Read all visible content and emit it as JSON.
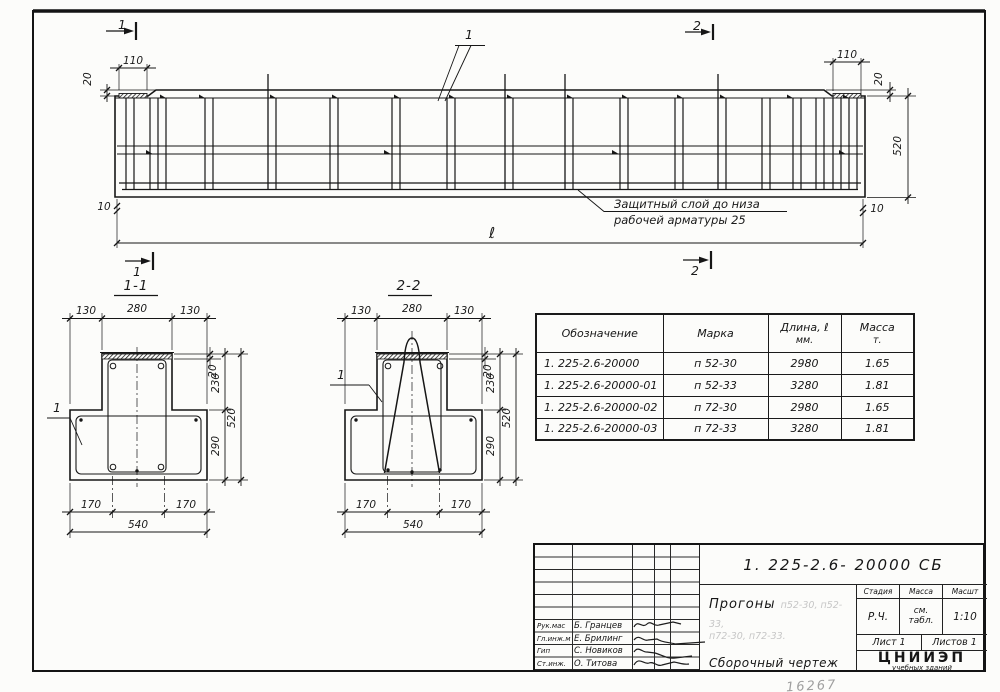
{
  "sheet": {
    "margin_note": "16267"
  },
  "elevation": {
    "mark_top_left": "1",
    "mark_top_right": "2",
    "mark_bottom_left": "1",
    "mark_bottom_right": "2",
    "callout": "1",
    "dim_pad_left": "110",
    "dim_pad_right": "110",
    "dim_step_left": "20",
    "dim_step_right": "20",
    "dim_height": "520",
    "dim_gap_left": "10",
    "dim_gap_right": "10",
    "dim_length": "ℓ",
    "note_line1": "Защитный слой до низа",
    "note_line2": "рабочей арматуры  25"
  },
  "section_1_1": {
    "title": "1-1",
    "callout": "1",
    "dim_top_left": "130",
    "dim_top_mid": "280",
    "dim_top_right": "130",
    "dim_strip": "20",
    "dim_web_h": "230",
    "dim_flange_h": "290",
    "dim_total_h": "520",
    "dim_bot_left": "170",
    "dim_bot_right": "170",
    "dim_width": "540"
  },
  "section_2_2": {
    "title": "2-2",
    "callout": "1",
    "dim_top_left": "130",
    "dim_top_mid": "280",
    "dim_top_right": "130",
    "dim_strip": "20",
    "dim_web_h": "230",
    "dim_flange_h": "290",
    "dim_total_h": "520",
    "dim_bot_left": "170",
    "dim_bot_right": "170",
    "dim_width": "540"
  },
  "parts_table": {
    "header_designation": "Обозначение",
    "header_mark": "Марка",
    "header_length_1": "Длина, ℓ",
    "header_length_2": "мм.",
    "header_mass_1": "Масса",
    "header_mass_2": "т.",
    "rows": [
      {
        "designation": "1. 225-2.6-20000",
        "mark": "п 52-30",
        "length": "2980",
        "mass": "1.65"
      },
      {
        "designation": "1. 225-2.6-20000-01",
        "mark": "п 52-33",
        "length": "3280",
        "mass": "1.81"
      },
      {
        "designation": "1. 225-2.6-20000-02",
        "mark": "п 72-30",
        "length": "2980",
        "mass": "1.65"
      },
      {
        "designation": "1. 225-2.6-20000-03",
        "mark": "п 72-33",
        "length": "3280",
        "mass": "1.81"
      }
    ]
  },
  "title_block": {
    "designation": "1. 225-2.6- 20000 СБ",
    "product": "Прогоны",
    "faint_marks_1": "п52-30, п52-33,",
    "faint_marks_2": "п72-30, п72-33.",
    "doc_type": "Сборочный чертеж",
    "stage_label": "Стадия",
    "mass_label": "Масса",
    "scale_label": "Масшт",
    "stage_value": "Р.Ч.",
    "mass_value_1": "см.",
    "mass_value_2": "табл.",
    "scale_value": "1:10",
    "sheet_label": "Лист 1",
    "sheets_label": "Листов 1",
    "org_name": "ЦНИИЭП",
    "org_sub_1": "учебных зданий",
    "org_sub_2": "г. Москва",
    "roles": [
      {
        "role": "Рук.мас",
        "name": "Б. Гранцев"
      },
      {
        "role": "Гл.инж.м",
        "name": "Е. Брилинг"
      },
      {
        "role": "Гип",
        "name": "С. Новиков"
      },
      {
        "role": "Ст.инж.",
        "name": "О. Титова"
      }
    ]
  }
}
